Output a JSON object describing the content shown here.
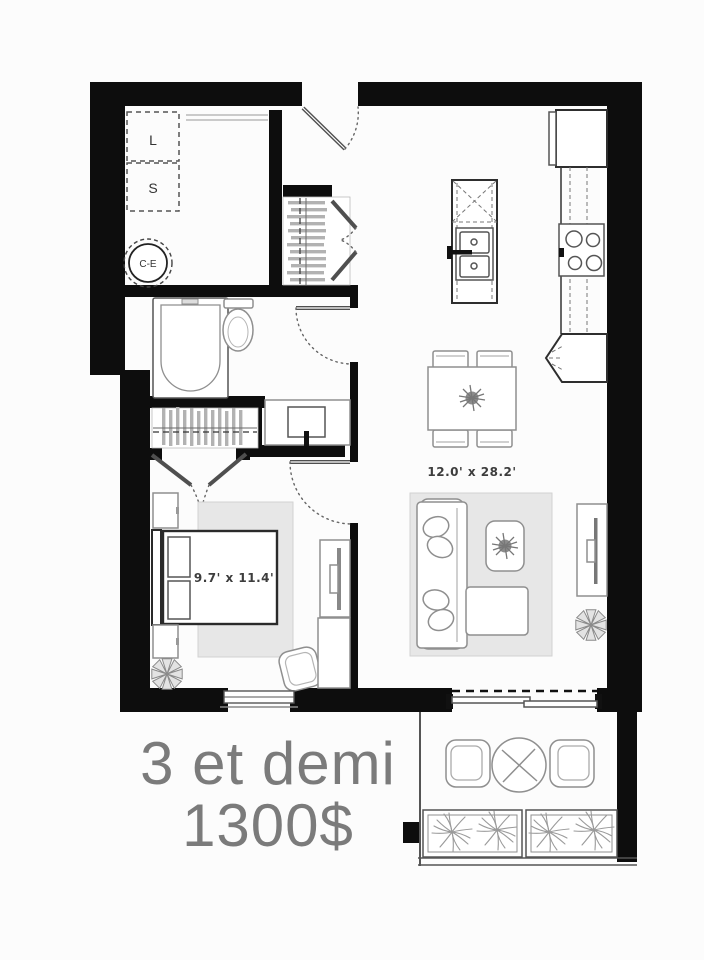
{
  "listing": {
    "unit_type": "3 et demi",
    "price": "1300$"
  },
  "labels": {
    "washer": "L",
    "dryer": "S",
    "water_heater": "C-E"
  },
  "dimensions": {
    "living_dining": "12.0' x 28.2'",
    "bedroom": "9.7' x 11.4'"
  },
  "colors": {
    "wall": "#0d0d0d",
    "listing_text": "#7b7b7b",
    "rug": "#e7e7e7",
    "dimension_text": "#3d3d3d"
  }
}
